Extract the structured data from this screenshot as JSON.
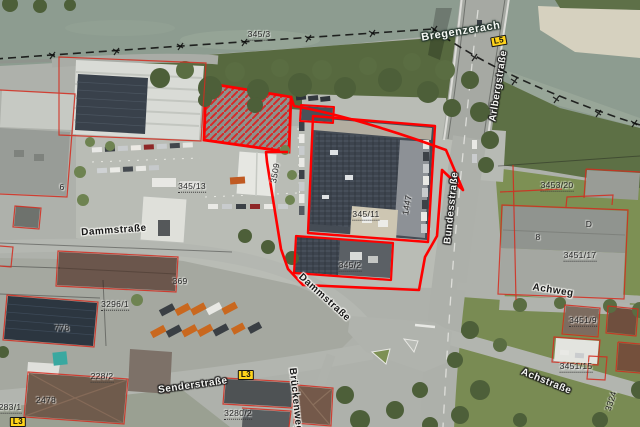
{
  "map": {
    "kind": "aerial-cadastral-map",
    "selection_note": "red outlined cadastral selection over commercial complex"
  },
  "colors": {
    "selection_red": "#ff0000",
    "cadastral_red": "#d42b1e",
    "shield_yellow": "#ffd41a",
    "water": "#8d9c90"
  },
  "street_labels": [
    {
      "text": "Bregenzerach",
      "x": 461,
      "y": 32,
      "rot": -9,
      "style": "water"
    },
    {
      "text": "Arlbergstraße",
      "x": 499,
      "y": 86,
      "rot": -81,
      "style": "major"
    },
    {
      "text": "Bundesstraße",
      "x": 452,
      "y": 208,
      "rot": -84,
      "style": "major"
    },
    {
      "text": "Dammstraße",
      "x": 114,
      "y": 231,
      "rot": -4,
      "style": "minor"
    },
    {
      "text": "Dammstraße",
      "x": 324,
      "y": 298,
      "rot": 42,
      "style": "minor"
    },
    {
      "text": "Senderstraße",
      "x": 193,
      "y": 386,
      "rot": -8,
      "style": "major"
    },
    {
      "text": "Achstraße",
      "x": 546,
      "y": 382,
      "rot": 22,
      "style": "major"
    },
    {
      "text": "Brückenweg",
      "x": 295,
      "y": 400,
      "rot": 84,
      "style": "minor"
    },
    {
      "text": "Achweg",
      "x": 553,
      "y": 291,
      "rot": 9,
      "style": "minor"
    }
  ],
  "parcel_labels": [
    {
      "text": "345/3",
      "x": 259,
      "y": 35
    },
    {
      "text": "345/13",
      "x": 192,
      "y": 187
    },
    {
      "text": "3509",
      "x": 275,
      "y": 173,
      "rot": -80
    },
    {
      "text": "345/11",
      "x": 366,
      "y": 215
    },
    {
      "text": "345/2",
      "x": 350,
      "y": 266
    },
    {
      "text": "1447",
      "x": 407,
      "y": 205,
      "rot": -80
    },
    {
      "text": "3296/1",
      "x": 115,
      "y": 305
    },
    {
      "text": "778",
      "x": 62,
      "y": 328
    },
    {
      "text": "369",
      "x": 180,
      "y": 281
    },
    {
      "text": "283/1",
      "x": 10,
      "y": 408
    },
    {
      "text": "2478",
      "x": 46,
      "y": 400
    },
    {
      "text": "228/2",
      "x": 102,
      "y": 377
    },
    {
      "text": "3280/2",
      "x": 238,
      "y": 414
    },
    {
      "text": "3453/20",
      "x": 557,
      "y": 186
    },
    {
      "text": "3451/17",
      "x": 580,
      "y": 256
    },
    {
      "text": "3451/9",
      "x": 583,
      "y": 321
    },
    {
      "text": "3451/15",
      "x": 576,
      "y": 367
    },
    {
      "text": "3324",
      "x": 611,
      "y": 401,
      "rot": -72
    },
    {
      "text": "8",
      "x": 538,
      "y": 237
    },
    {
      "text": "D",
      "x": 589,
      "y": 224
    },
    {
      "text": "6",
      "x": 62,
      "y": 187
    }
  ],
  "road_shields": [
    {
      "text": "L5",
      "x": 499,
      "y": 41,
      "rot": -10
    },
    {
      "text": "L3",
      "x": 246,
      "y": 375,
      "rot": 0
    },
    {
      "text": "L3",
      "x": 18,
      "y": 422,
      "rot": 0
    }
  ]
}
